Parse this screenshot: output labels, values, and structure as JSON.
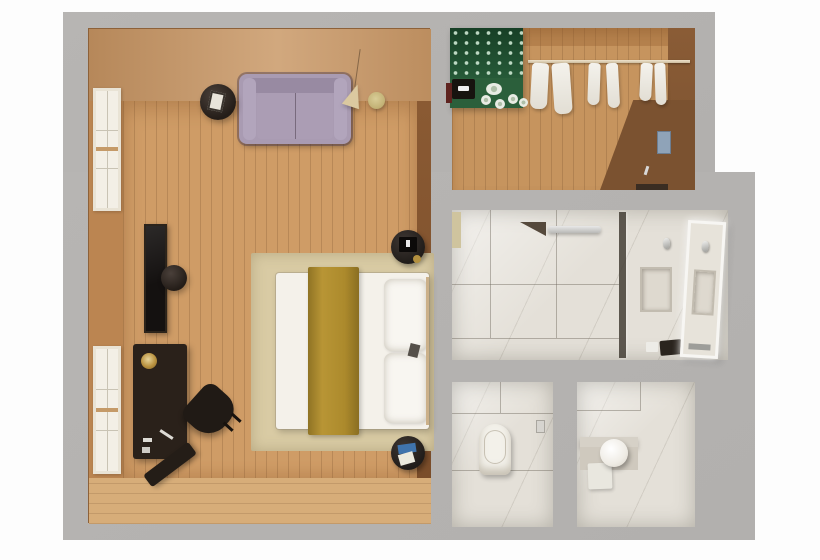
{
  "scene": {
    "kind": "top-down 3d floor plan render",
    "background_color": "#ffffff",
    "slab_color": "#b5b3b1"
  },
  "rooms": {
    "bedroom": {
      "label": "Bedroom",
      "floor_material": "wood",
      "floor_color": "#cf9c66",
      "wall_color": "#b97f4e",
      "furniture": [
        "sofa",
        "round side table",
        "pendant cone lamp",
        "gold wall disc",
        "wall tv",
        "stool",
        "desk",
        "desk lamp",
        "desk chair",
        "angled bench",
        "area rug",
        "double bed",
        "mustard bed runner",
        "two pillows",
        "round nightstand upper",
        "round nightstand lower",
        "window upper",
        "window lower"
      ]
    },
    "closet": {
      "label": "Walk-in closet",
      "floor_material": "wood",
      "features": [
        "green minibar cabinet with glassware",
        "coffee machine",
        "tea set",
        "hanging rod",
        "six hanging garments",
        "blue wall panel",
        "door threshold"
      ]
    },
    "bathroom": {
      "label": "Bathroom",
      "floor_material": "marble",
      "features": [
        "walk-in shower",
        "shower head bar",
        "corner shelf",
        "glass partition",
        "sink niche",
        "faucet",
        "lit mirror door",
        "toiletry kit",
        "soap"
      ]
    },
    "wc_left": {
      "label": "Toilet room",
      "floor_material": "marble",
      "features": [
        "toilet",
        "toilet paper holder"
      ]
    },
    "wc_right": {
      "label": "Washbasin room",
      "floor_material": "marble",
      "features": [
        "round basin",
        "marble bench",
        "towel box"
      ]
    }
  },
  "colors": {
    "sofa": "#a99bb2",
    "bed_runner": "#ac8a2c",
    "rug": "#d9cba4",
    "minibar_green": "#265a38",
    "marble": "#e4e0d8",
    "dark_furniture": "#241d18",
    "wood_floor": "#cf9c66"
  }
}
